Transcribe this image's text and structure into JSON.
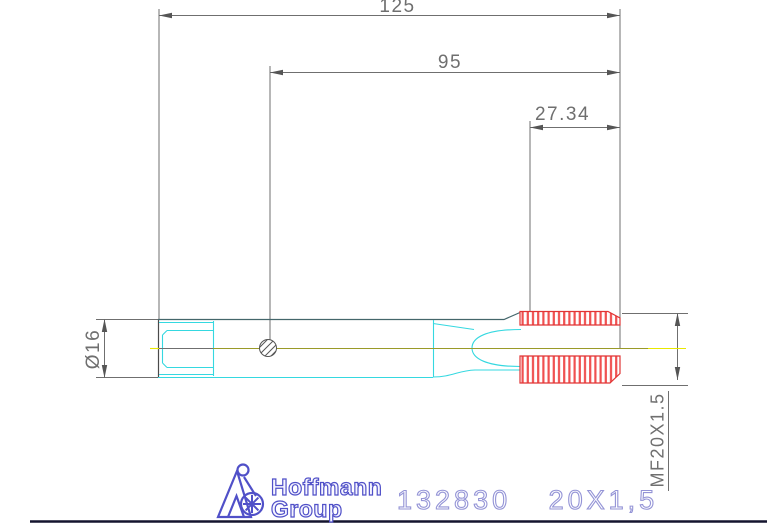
{
  "dimensions": {
    "total_length": "125",
    "shank_length": "95",
    "thread_length": "27.34",
    "shank_diameter": "Ø16",
    "thread_spec": "MF20X1.5"
  },
  "footer": {
    "brand_line1": "Hoffmann",
    "brand_line2": "Group",
    "part_number": "132830",
    "size": "20X1,5"
  },
  "colors": {
    "dimension_gray": "#6f6f6f",
    "outline_dark": "#44666b",
    "body_cyan": "#35d8e0",
    "thread_red": "#e03535",
    "centerline_olive": "#9a9a28",
    "centerline_yellow": "#e8e800",
    "brand_blue": "#5050c8",
    "part_text_blue": "#9494d6",
    "border_dark": "#14142e"
  },
  "icons": {
    "logo_mark": "hoffmann-figure-with-star-wheel"
  }
}
